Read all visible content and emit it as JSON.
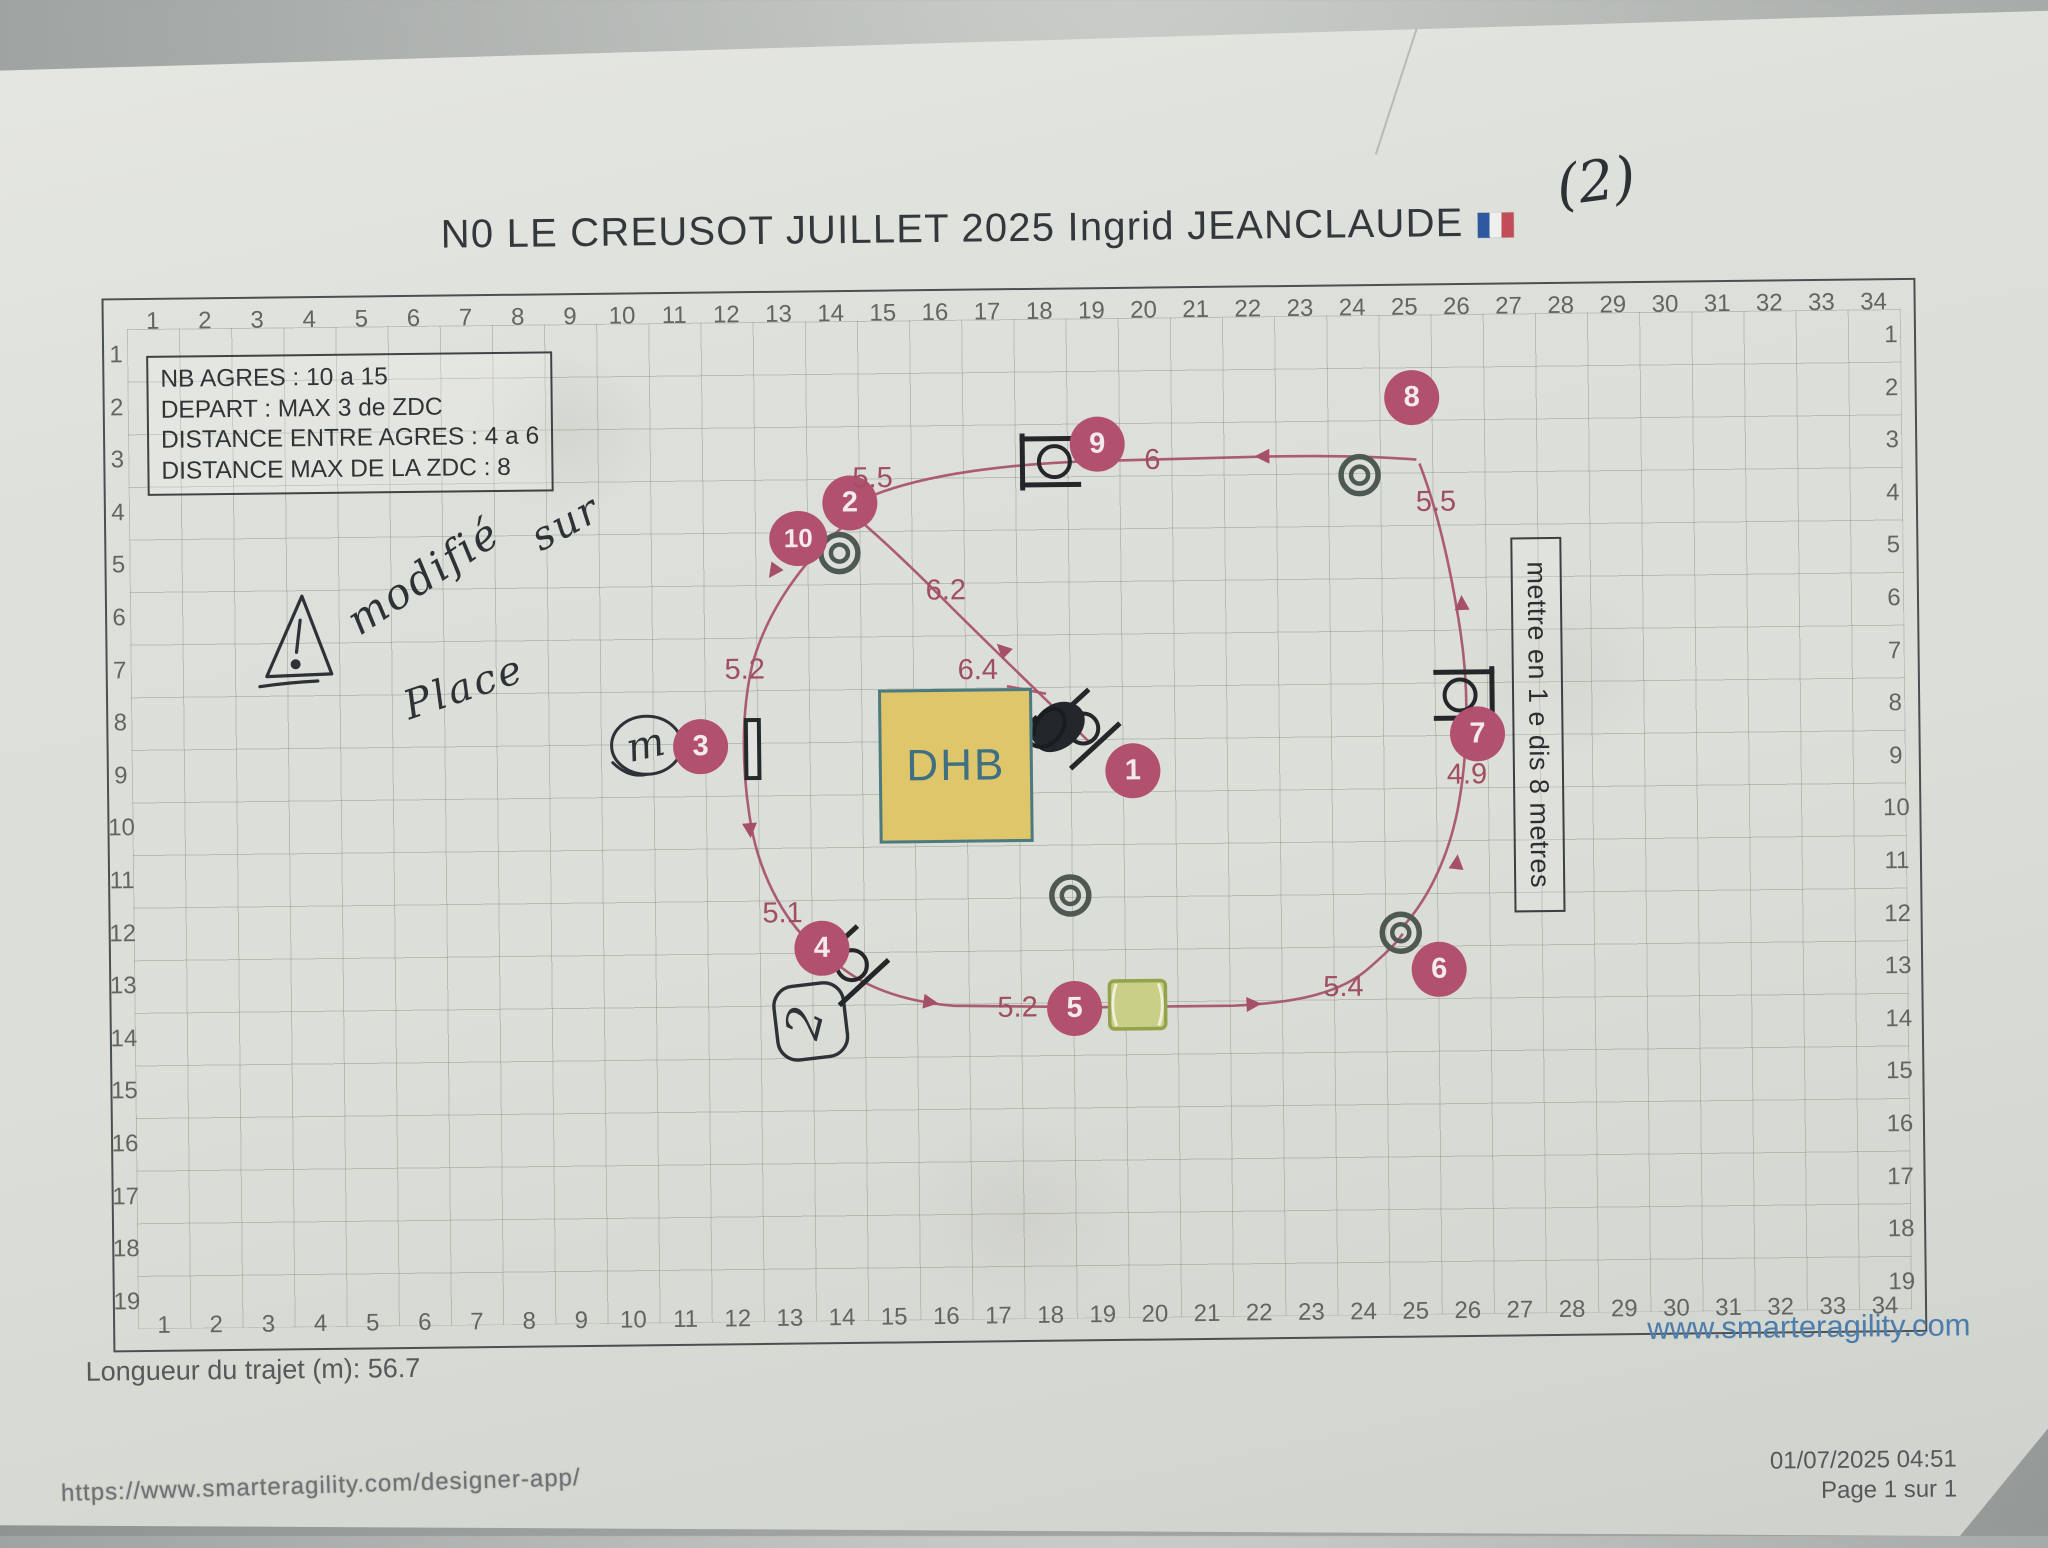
{
  "title": {
    "text": "N0 LE CREUSOT JUILLET 2025 Ingrid JEANCLAUDE",
    "flag_icon": "french-flag",
    "handwritten_suffix": "(2)"
  },
  "info_box": {
    "lines": [
      "NB AGRES : 10 a 15",
      "DEPART : MAX 3 de ZDC",
      "DISTANCE ENTRE AGRES : 4 a 6",
      "DISTANCE MAX DE LA ZDC : 8"
    ]
  },
  "grid": {
    "cols": 34,
    "rows": 19
  },
  "course": {
    "dhb_label": "DHB",
    "note_box_text": "mettre en 1 e dis 8 metres",
    "obstacles": [
      {
        "n": "1",
        "x": 1132,
        "y": 772
      },
      {
        "n": "2",
        "x": 852,
        "y": 501
      },
      {
        "n": "3",
        "x": 700,
        "y": 743
      },
      {
        "n": "4",
        "x": 819,
        "y": 946
      },
      {
        "n": "5",
        "x": 1071,
        "y": 1009
      },
      {
        "n": "6",
        "x": 1436,
        "y": 974
      },
      {
        "n": "7",
        "x": 1477,
        "y": 739
      },
      {
        "n": "8",
        "x": 1415,
        "y": 402
      },
      {
        "n": "9",
        "x": 1100,
        "y": 445
      },
      {
        "n": "10",
        "x": 800,
        "y": 536
      }
    ],
    "distances": [
      {
        "text": "5.5",
        "x": 875,
        "y": 477
      },
      {
        "text": "6",
        "x": 1155,
        "y": 462
      },
      {
        "text": "5.5",
        "x": 1438,
        "y": 507
      },
      {
        "text": "6.2",
        "x": 947,
        "y": 590
      },
      {
        "text": "6.4",
        "x": 978,
        "y": 670
      },
      {
        "text": "5.2",
        "x": 745,
        "y": 667
      },
      {
        "text": "5.1",
        "x": 780,
        "y": 911
      },
      {
        "text": "5.2",
        "x": 1014,
        "y": 1008
      },
      {
        "text": "5.4",
        "x": 1340,
        "y": 991
      },
      {
        "text": "4.9",
        "x": 1466,
        "y": 780
      }
    ],
    "equipment": [
      {
        "type": "tunnel-entrance",
        "x": 841,
        "y": 551
      },
      {
        "type": "tunnel-entrance",
        "x": 1362,
        "y": 479
      },
      {
        "type": "tunnel-entrance",
        "x": 1398,
        "y": 937
      },
      {
        "type": "tunnel-entrance",
        "x": 1068,
        "y": 896
      },
      {
        "type": "tire-jump",
        "x": 1051,
        "y": 462,
        "rot": 0,
        "mirror": false
      },
      {
        "type": "tire-jump",
        "x": 1466,
        "y": 700,
        "rot": 0,
        "mirror": true
      },
      {
        "type": "bar-jump",
        "x": 1080,
        "y": 729,
        "rot": -42,
        "scribble": true
      },
      {
        "type": "bar-jump",
        "x": 846,
        "y": 963,
        "rot": -42,
        "scribble": false
      },
      {
        "type": "wall",
        "x": 752,
        "y": 746
      },
      {
        "type": "pipe",
        "x": 1134,
        "y": 1006
      }
    ],
    "paths": [
      "M 1419,464 C 1350,458 1280,459 1220,460 L 1090,462 C 1010,464 930,473 877,493 C 863,499 855,507 848,517",
      "M 1402,929 C 1427,901 1446,862 1456,816 C 1468,758 1469,692 1461,636 C 1452,572 1440,516 1422,468",
      "M 830,958 C 858,985 900,1000 950,1005 L 1098,1008 L 1230,1008 C 1292,1006 1338,997 1367,971 C 1382,958 1393,948 1400,938",
      "M 849,521 C 800,562 768,610 753,660 C 741,708 741,762 748,812 C 755,866 779,916 813,946",
      "M 1090,744 C 1038,692 986,641 948,602 C 915,568 884,538 860,517",
      "M 1007,686 L 1046,694"
    ],
    "arrows": [
      {
        "x": 1272,
        "y": 459,
        "angle": 180
      },
      {
        "x": 1008,
        "y": 654,
        "angle": -135
      },
      {
        "x": 779,
        "y": 563,
        "angle": 126
      },
      {
        "x": 748,
        "y": 820,
        "angle": 86
      },
      {
        "x": 920,
        "y": 1000,
        "angle": 9
      },
      {
        "x": 1243,
        "y": 1007,
        "angle": -2
      },
      {
        "x": 1454,
        "y": 874,
        "angle": -83
      },
      {
        "x": 1463,
        "y": 615,
        "angle": -92
      }
    ],
    "path_color": "#a65068",
    "obstacle_color": "#b25070",
    "dhb_fill": "#e0c66b",
    "dhb_border": "#4b7a80",
    "pipe_fill": "#c9cf86"
  },
  "handwriting": {
    "warning_mark": "!",
    "line1": "modifié",
    "line2": "sur",
    "line3": "Place",
    "circled_letter": "m",
    "circled_number": "2"
  },
  "footer": {
    "length_text": "Longueur du trajet (m): 56.7",
    "website": "www.smarteragility.com",
    "print_url": "https://www.smarteragility.com/designer-app/",
    "print_datetime": "01/07/2025 04:51",
    "print_page": "Page 1 sur 1"
  }
}
